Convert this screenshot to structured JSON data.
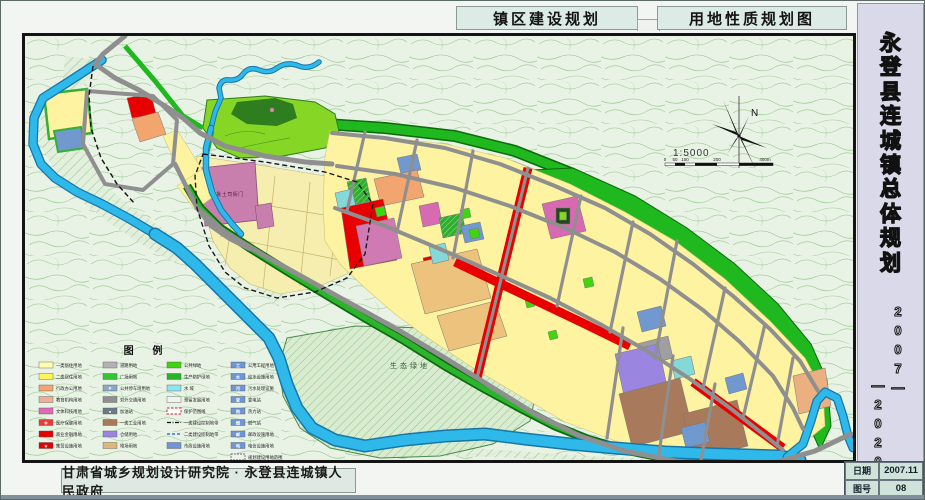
{
  "header": {
    "title_left": "镇区建设规划",
    "title_right": "用地性质规划图"
  },
  "sidebar": {
    "title_chars": [
      "永",
      "登",
      "县",
      "连",
      "城",
      "镇",
      "总",
      "体",
      "规",
      "划"
    ],
    "year_col_right": [
      "2",
      "0",
      "0",
      "7",
      "—"
    ],
    "year_col_left": [
      "—",
      "2",
      "0",
      "2",
      "0"
    ]
  },
  "footer": {
    "credit": "甘肃省城乡规划设计研究院 · 永登县连城镇人民政府"
  },
  "titleblock": {
    "date_label": "日期",
    "date_value": "2007.11",
    "sheet_label": "图号",
    "sheet_value": "08"
  },
  "map": {
    "north_label": "N",
    "scale_text": "1:5000",
    "scale_ticks": [
      "0",
      "50",
      "100",
      "200",
      "400m"
    ],
    "labels": {
      "eco": "生态绿地",
      "heritage": "鲁土司衙门"
    },
    "colors": {
      "topo_bg": "#e9f3e5",
      "contour": "#a3cc9b",
      "river": "#2fb9ea",
      "green_belt": "#1fb81f",
      "park": "#86d626",
      "residential_1": "#fffbb0",
      "residential_2": "#fdf3a0",
      "commercial": "#e80000",
      "culture": "#d76ab0",
      "education": "#f2a56e",
      "industry_brown": "#a8795a",
      "warehouse": "#9a86e0",
      "utility_blue": "#7298d0",
      "road_gray": "#8f8f8f"
    }
  },
  "legend": {
    "title": "图 例",
    "columns": [
      [
        {
          "label": "一类居住用地",
          "color": "#fffbb0"
        },
        {
          "label": "二类居住用地",
          "color": "#fff45e"
        },
        {
          "label": "行政办公用地",
          "color": "#f2a56e"
        },
        {
          "label": "教育机构用地",
          "color": "#efae9b"
        },
        {
          "label": "文体科技用地",
          "color": "#e06ab8"
        },
        {
          "label": "医疗保健用地",
          "color": "#e83c3c",
          "icon": "✚"
        },
        {
          "label": "商业金融用地",
          "color": "#e60000"
        },
        {
          "label": "集贸设施用地",
          "color": "#e60000",
          "icon": "★"
        }
      ],
      [
        {
          "label": "道路用地",
          "color": "#b3b3b3"
        },
        {
          "label": "广场用地",
          "color": "#35c435"
        },
        {
          "label": "公共停车场用地",
          "color": "#8aa8c8",
          "icon": "P"
        },
        {
          "label": "对外交通用地",
          "color": "#8f8f8f"
        },
        {
          "label": "加油站",
          "color": "#6a7a88",
          "icon": "●"
        },
        {
          "label": "一类工业用地",
          "color": "#a8795a"
        },
        {
          "label": "仓储用地",
          "color": "#9a86e0"
        },
        {
          "label": "堆场用地",
          "color": "#dfb878"
        }
      ],
      [
        {
          "label": "公共绿地",
          "color": "#3ed60e"
        },
        {
          "label": "生产防护绿地",
          "color": "#28b428"
        },
        {
          "label": "水 域",
          "color": "#8ce6f2"
        },
        {
          "label": "预留发展用地",
          "color": "#eef6ea"
        },
        {
          "label": "保护范围线",
          "type": "dash-red"
        },
        {
          "label": "一类建设控制地带",
          "type": "line-black"
        },
        {
          "label": "二类建设控制地带",
          "type": "line-blue"
        },
        {
          "label": "市政设施用地",
          "color": "#6e96d6"
        }
      ],
      [
        {
          "label": "公用工程用地",
          "color": "#6e96d6",
          "icon": "工"
        },
        {
          "label": "给水设施用地",
          "color": "#6e96d6",
          "icon": "水"
        },
        {
          "label": "污水处理设施",
          "color": "#6e96d6",
          "icon": "污"
        },
        {
          "label": "变电站",
          "color": "#6e96d6",
          "icon": "变"
        },
        {
          "label": "热力站",
          "color": "#6e96d6",
          "icon": "热"
        },
        {
          "label": "燃气站",
          "color": "#6e96d6",
          "icon": "燃"
        },
        {
          "label": "邮政设施用地",
          "color": "#6e96d6",
          "icon": "邮"
        },
        {
          "label": "电信设施用地",
          "color": "#6e96d6",
          "icon": "电"
        },
        {
          "label": "规划建设用地范围",
          "type": "outline"
        }
      ]
    ]
  }
}
